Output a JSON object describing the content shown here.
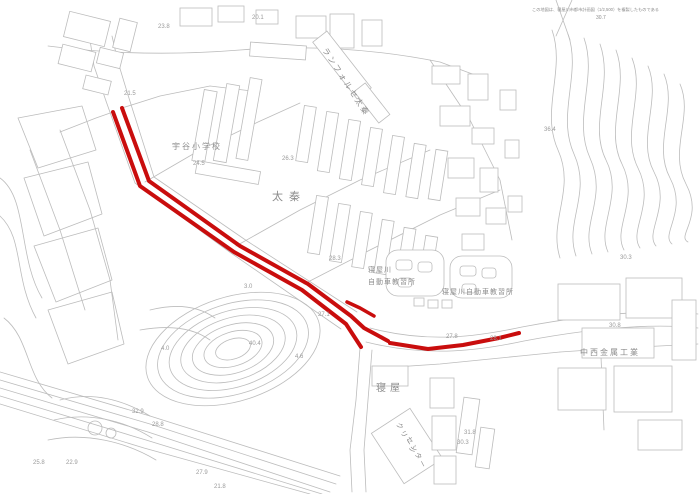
{
  "map": {
    "background": "#ffffff",
    "line_color": "#bcbcbc",
    "label_color": "#8c8c8c",
    "elevation_color": "#9a9a9a",
    "route_color": "#c90d0d",
    "labels": [
      {
        "text": "この地図は、寝屋川市都市計画図（1/2,500）を複製したものである",
        "x": 532,
        "y": 11,
        "size": 4.2,
        "spacing": 0,
        "name": "map-reference-text"
      },
      {
        "text": "30.7",
        "x": 596,
        "y": 19,
        "size": 5,
        "name": "elevation-30-7"
      },
      {
        "text": "宇谷小学校",
        "x": 172,
        "y": 149,
        "size": 8,
        "spacing": 2,
        "name": "label-udani-elementary-school"
      },
      {
        "text": "太秦",
        "x": 272,
        "y": 200,
        "size": 11,
        "spacing": 6,
        "name": "label-uzumasa"
      },
      {
        "text": "ランフォルセ太秦",
        "x": 322,
        "y": 50,
        "size": 8,
        "rot": 57,
        "spacing": 2,
        "name": "label-lanforce-uzumasa"
      },
      {
        "text": "寝屋川",
        "x": 368,
        "y": 272,
        "size": 7,
        "spacing": 1,
        "name": "label-neyagawa-driving-school-line1"
      },
      {
        "text": "自動車教習所",
        "x": 368,
        "y": 284,
        "size": 7,
        "spacing": 1,
        "name": "label-neyagawa-driving-school-line2"
      },
      {
        "text": "寝屋川自動車教習所",
        "x": 442,
        "y": 294,
        "size": 7,
        "spacing": 1,
        "name": "label-neyagawa-driving-school"
      },
      {
        "text": "中西金属工業",
        "x": 580,
        "y": 355,
        "size": 8,
        "spacing": 2,
        "name": "label-nakanishi-metal-works"
      },
      {
        "text": "寝屋",
        "x": 376,
        "y": 391,
        "size": 10,
        "spacing": 4,
        "name": "label-neya"
      },
      {
        "text": "クリーン",
        "x": 396,
        "y": 424,
        "size": 7,
        "rot": 62,
        "spacing": 2,
        "name": "label-clean-center-line1"
      },
      {
        "text": "センター",
        "x": 406,
        "y": 438,
        "size": 7,
        "rot": 62,
        "spacing": 2,
        "name": "label-clean-center-line2"
      }
    ],
    "elevations": [
      {
        "v": "20.1",
        "x": 252,
        "y": 19
      },
      {
        "v": "23.8",
        "x": 158,
        "y": 28
      },
      {
        "v": "21.5",
        "x": 124,
        "y": 95
      },
      {
        "v": "24.5",
        "x": 193,
        "y": 165
      },
      {
        "v": "26.3",
        "x": 282,
        "y": 160
      },
      {
        "v": "36.4",
        "x": 544,
        "y": 131
      },
      {
        "v": "28.3",
        "x": 329,
        "y": 260
      },
      {
        "v": "27.1",
        "x": 318,
        "y": 316
      },
      {
        "v": "30.3",
        "x": 620,
        "y": 259
      },
      {
        "v": "30.8",
        "x": 609,
        "y": 327
      },
      {
        "v": "27.8",
        "x": 446,
        "y": 338
      },
      {
        "v": "28.1",
        "x": 490,
        "y": 340
      },
      {
        "v": "40.4",
        "x": 249,
        "y": 345
      },
      {
        "v": "4.0",
        "x": 161,
        "y": 350
      },
      {
        "v": "3.0",
        "x": 244,
        "y": 288
      },
      {
        "v": "4.6",
        "x": 295,
        "y": 358
      },
      {
        "v": "32.9",
        "x": 132,
        "y": 413
      },
      {
        "v": "28.8",
        "x": 152,
        "y": 426
      },
      {
        "v": "22.9",
        "x": 66,
        "y": 464
      },
      {
        "v": "25.8",
        "x": 33,
        "y": 464
      },
      {
        "v": "27.9",
        "x": 196,
        "y": 474
      },
      {
        "v": "31.8",
        "x": 464,
        "y": 434
      },
      {
        "v": "30.3",
        "x": 457,
        "y": 444
      },
      {
        "v": "21.8",
        "x": 214,
        "y": 488
      }
    ],
    "route": {
      "description": "highlighted road section (red double line with east branch)",
      "segments": [
        {
          "name": "route-west-edge",
          "points": "113,112 140,186 234,252 302,290 346,324 361,347",
          "width": 4
        },
        {
          "name": "route-east-edge",
          "points": "122,108 149,181 240,246 308,284 351,316 364,328 377,335 388,341",
          "width": 4
        },
        {
          "name": "route-east-branch",
          "points": "390,343 428,349 463,345 499,338 519,333",
          "width": 4
        },
        {
          "name": "route-spur",
          "points": "347,302 360,308 374,316",
          "width": 3.5
        }
      ]
    }
  }
}
